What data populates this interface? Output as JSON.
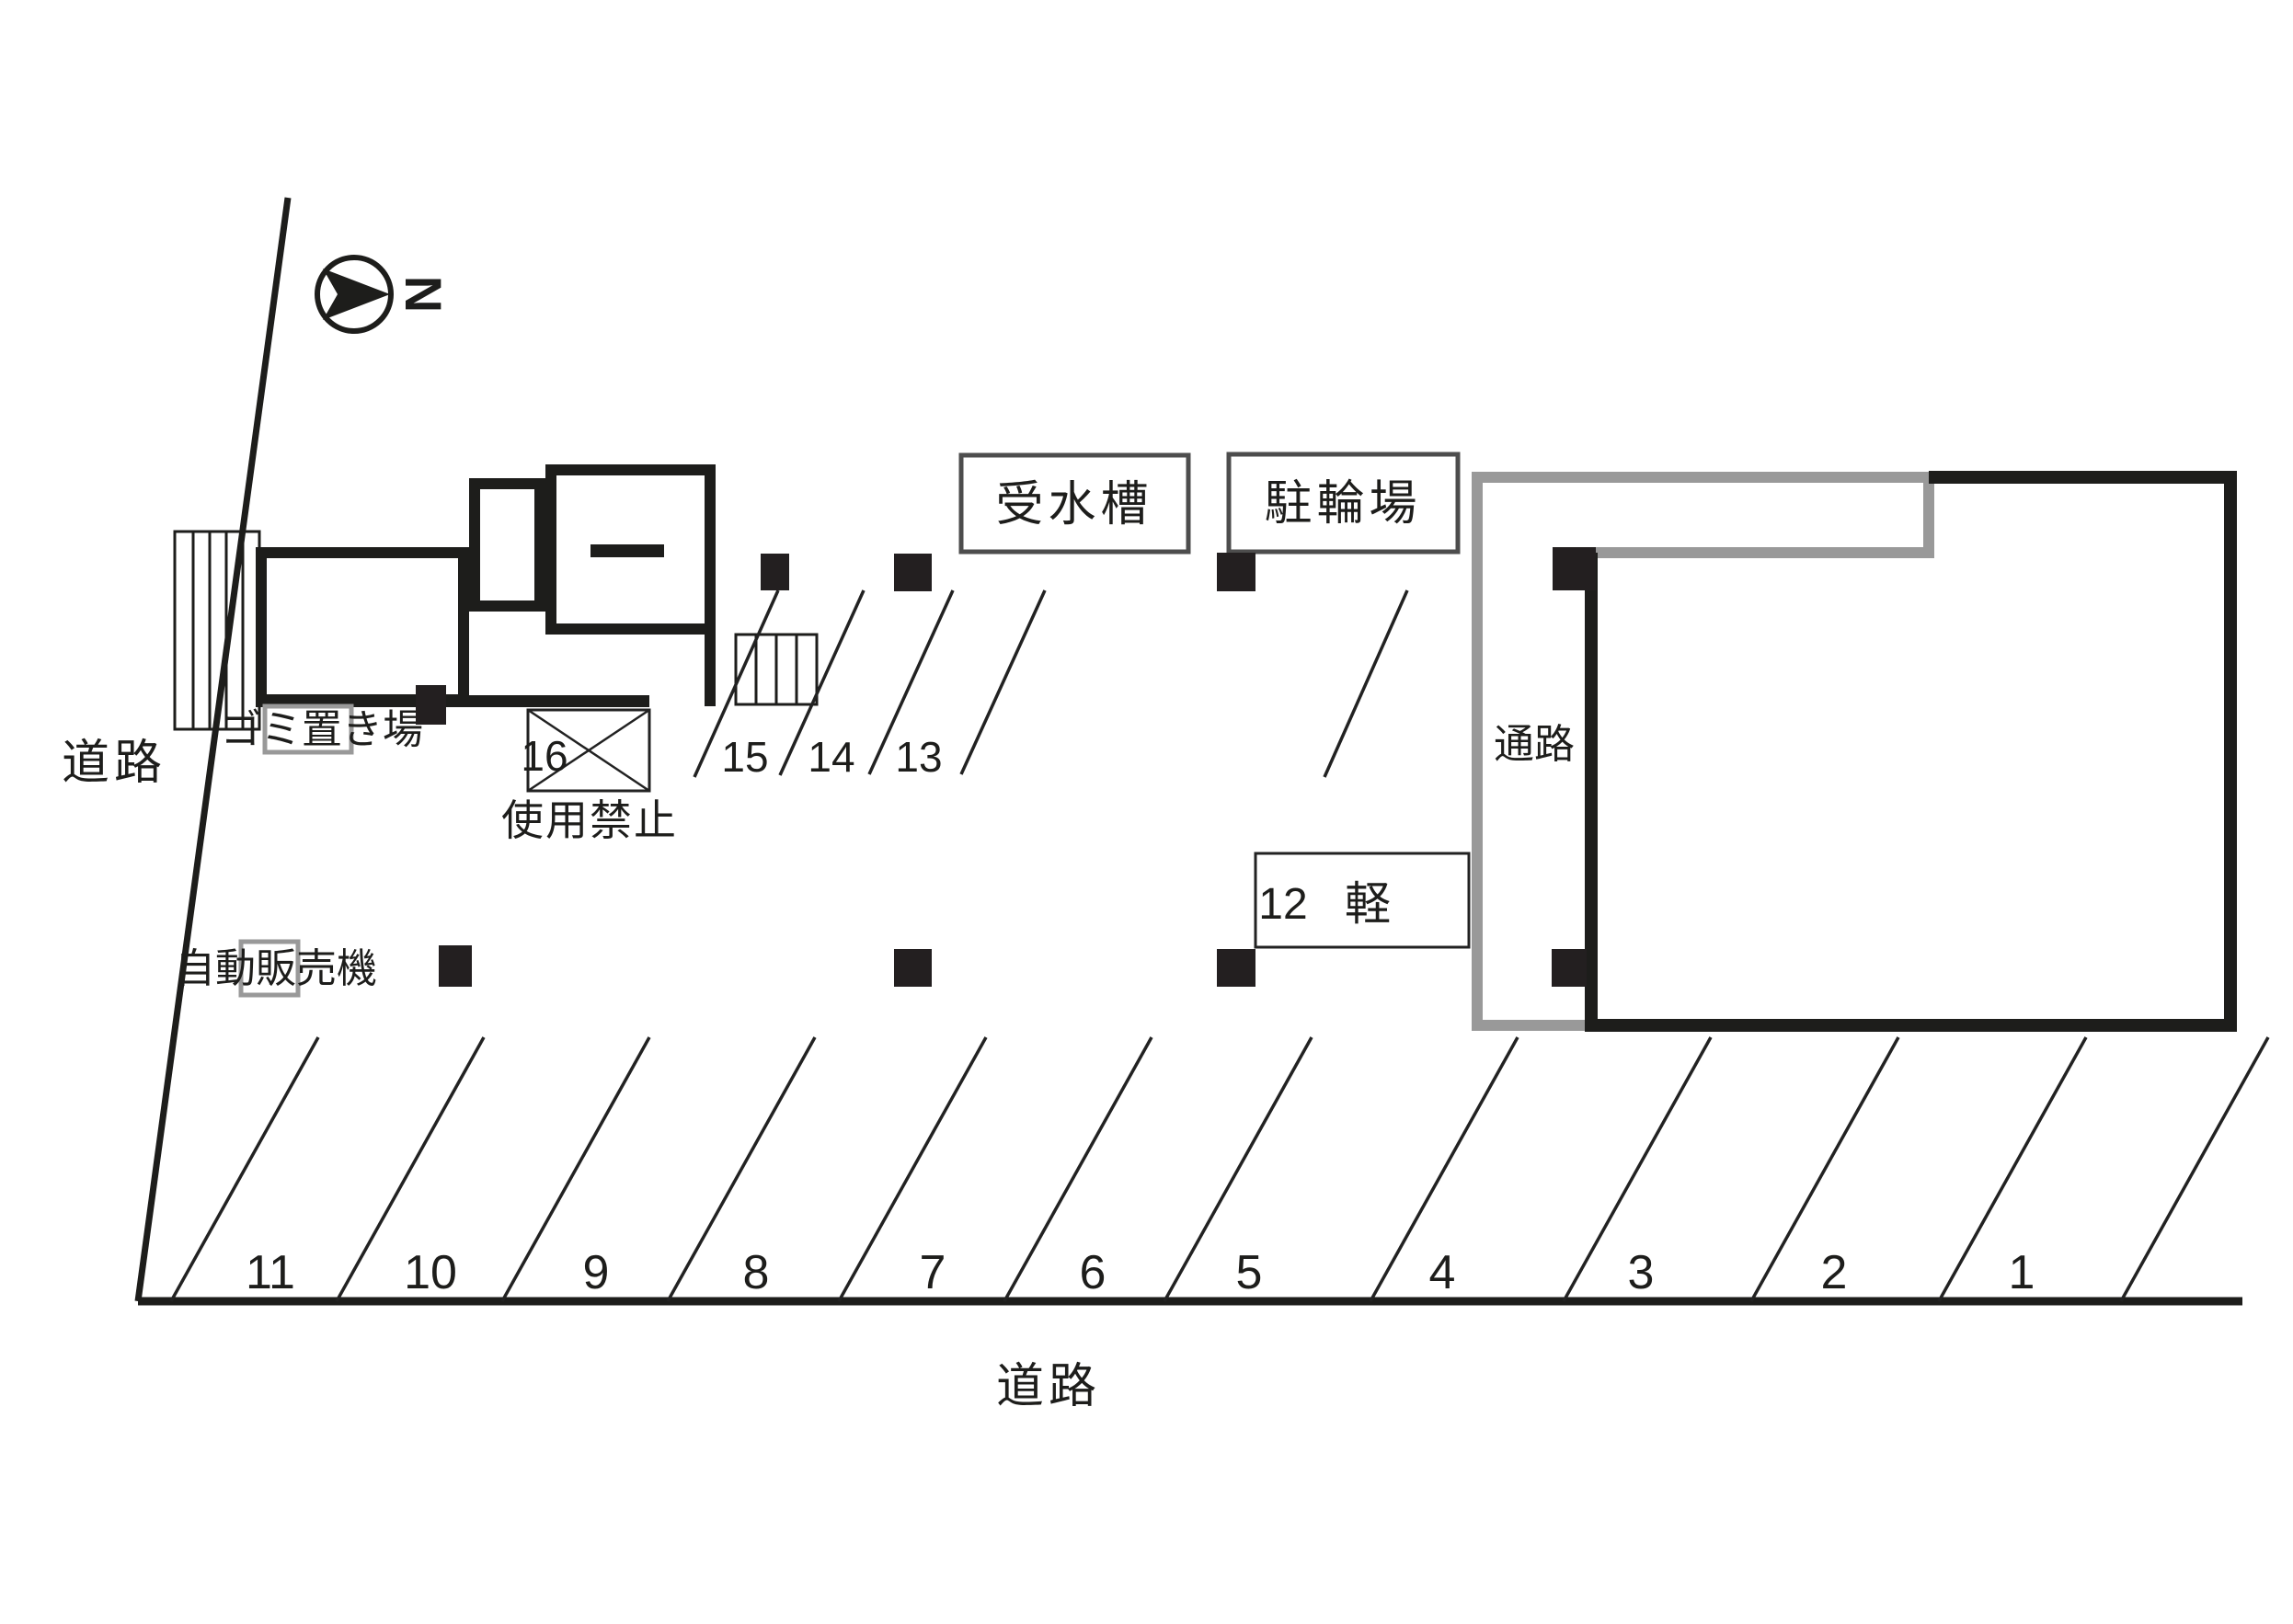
{
  "compass": {
    "north_label": "N"
  },
  "roads": {
    "left_label": "道路",
    "bottom_label": "道路"
  },
  "facilities": {
    "garbage_area": "ゴミ置き場",
    "vending_machine": "自動販売機",
    "water_tank": "受水槽",
    "bicycle_parking": "駐輪場",
    "passage": "通路",
    "prohibited": "使用禁止"
  },
  "spaces": {
    "row_middle": [
      {
        "label": "16"
      },
      {
        "label": "15"
      },
      {
        "label": "14"
      },
      {
        "label": "13"
      },
      {
        "label": "12"
      }
    ],
    "kei_label": "軽",
    "row_bottom": [
      {
        "label": "11"
      },
      {
        "label": "10"
      },
      {
        "label": "9"
      },
      {
        "label": "8"
      },
      {
        "label": "7"
      },
      {
        "label": "6"
      },
      {
        "label": "5"
      },
      {
        "label": "4"
      },
      {
        "label": "3"
      },
      {
        "label": "2"
      },
      {
        "label": "1"
      }
    ]
  }
}
